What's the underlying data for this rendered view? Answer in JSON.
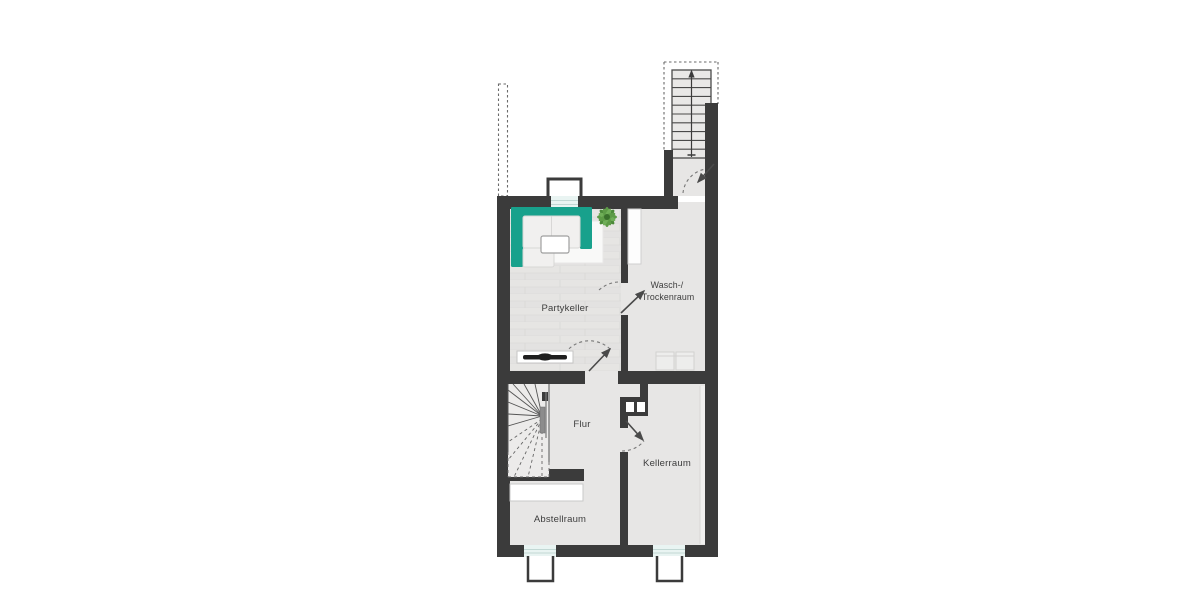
{
  "rooms": {
    "partykeller": {
      "label": "Partykeller"
    },
    "wasch_trockenraum": {
      "label_line1": "Wasch-/",
      "label_line2": "Trockenraum"
    },
    "flur": {
      "label": "Flur"
    },
    "kellerraum": {
      "label": "Kellerraum"
    },
    "abstellraum": {
      "label": "Abstellraum"
    }
  },
  "colors": {
    "wall": "#3b3b3b",
    "room_floor": "#e7e6e5",
    "sofa_accent": "#18a18c",
    "plant_green": "#5d9b47",
    "window_glazing": "#e9f4f2",
    "label_text": "#3d3d3d"
  },
  "furniture": {
    "sofa": "corner-sofa",
    "rug": "rug",
    "table": "coffee-table",
    "plant": "potted-plant",
    "tv": "tv-on-sideboard",
    "appliances": "washer-dryer-pair",
    "counter": "wall-counter",
    "shelf": "storage-shelf"
  },
  "stairs": {
    "exterior": "exterior-entrance-stairs",
    "interior": "winder-staircase"
  }
}
